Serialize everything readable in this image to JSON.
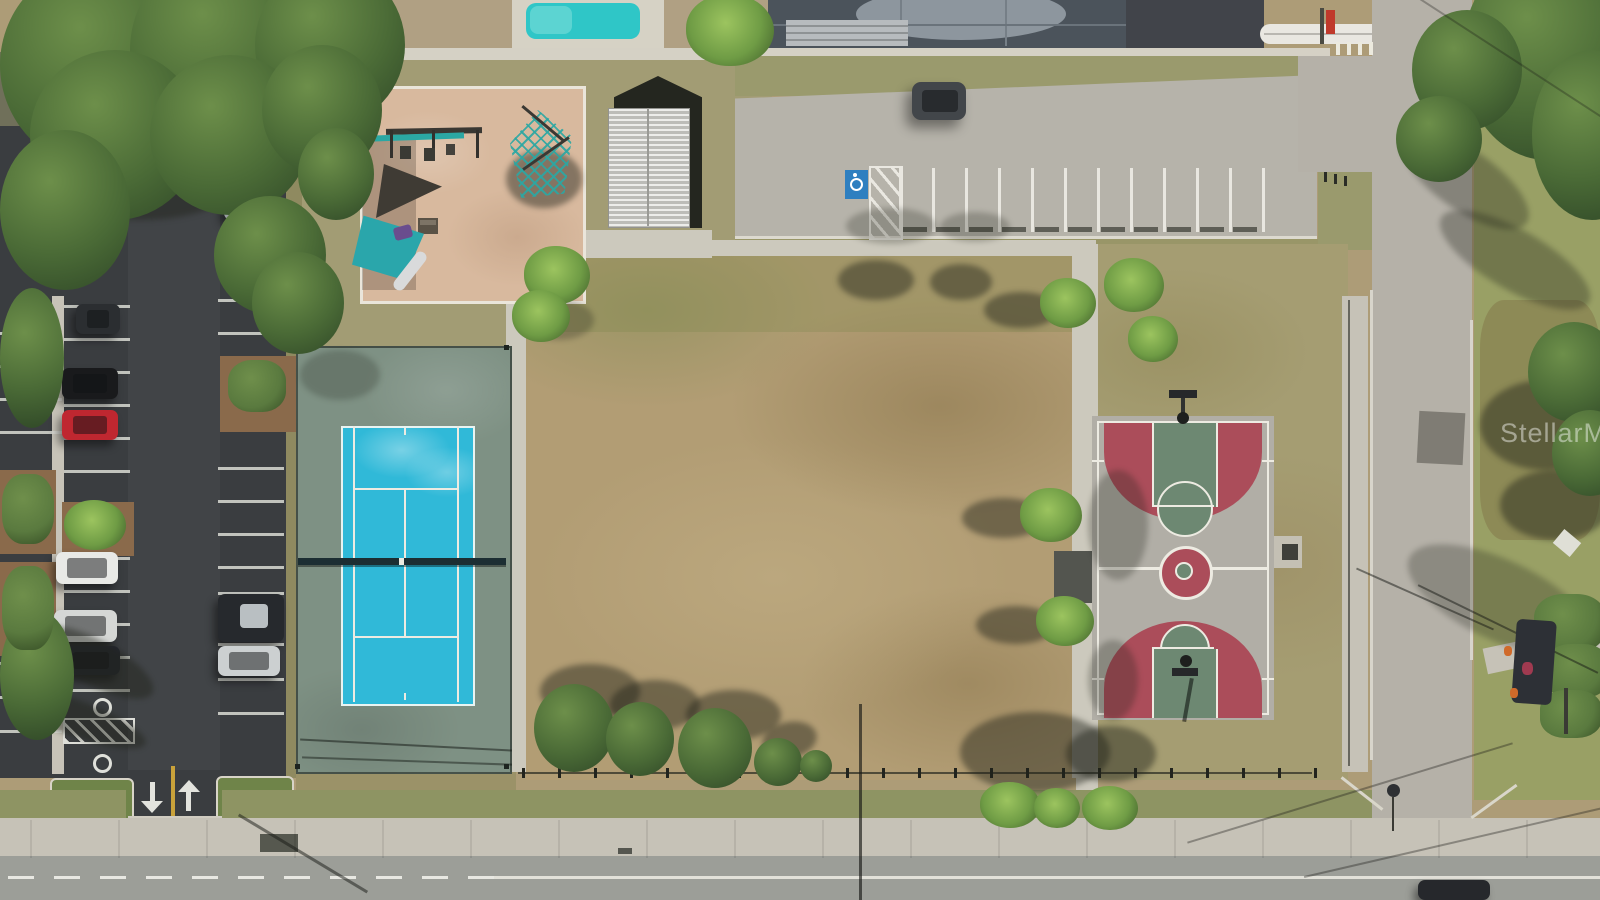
{
  "image": {
    "watermark_text": "StellarMLS",
    "description": "Aerial drone photograph of a public neighborhood park"
  },
  "scene": {
    "landmarks": [
      "playground",
      "pavilion",
      "tennis-court",
      "basketball-court",
      "west-parking-lot",
      "north-parking-lot",
      "dirt-field",
      "south-road",
      "east-road",
      "residential-pools",
      "swing-set",
      "shade-sails"
    ],
    "vehicles_west_lot": 9,
    "vehicles_north_lot": 1,
    "handicap_spaces": 3
  },
  "colors": {
    "asphalt": "#3a3d40",
    "roadBottom": "#9c9e98",
    "roadSide": "#b5b1a8",
    "concrete": "#ccc9bd",
    "concreteLot": "#b6b3aa",
    "sidewalk": "#c6c2b7",
    "field": "#b29d74",
    "grassYellow": "#a59d72",
    "grass": "#8e9463",
    "sand": "#d8b99e",
    "tennisPad": "#7e9184",
    "tennisBlue": "#30b9d8",
    "courtConcrete": "#b1aea6",
    "courtRed": "#ab4d5a",
    "courtGreen": "#6d8872",
    "lineWhite": "#edebe2",
    "treeDark": "#2f4727",
    "treeMid": "#4a6a36",
    "treeLight": "#6d8f4a",
    "palm": "#6f9c45",
    "hedge": "#5a7a3f",
    "mulch": "#8a6a4b",
    "pool": "#2fc6c7",
    "enclosure": "#4b535b",
    "handicapBlue": "#2e7fc0",
    "swingTeal": "#2ba7a3",
    "sailTeal": "#2aa6ab",
    "sailDark": "#3f3b34",
    "netDark": "#1c2e33",
    "yellowLine": "#c9a23a",
    "carDarkGray": "#2b2e31",
    "carBlack": "#191a1c",
    "carRed": "#bf2730",
    "carWhite": "#e8e9e6",
    "carSilver": "#d5d7d5",
    "carNavy": "#23262e",
    "carGray": "#9aa0a2",
    "suvDark": "#26292d",
    "suvSilver": "#ccd0d1",
    "carTopLot": "#42464a",
    "shadow": "rgba(30,34,24,0.45)"
  }
}
